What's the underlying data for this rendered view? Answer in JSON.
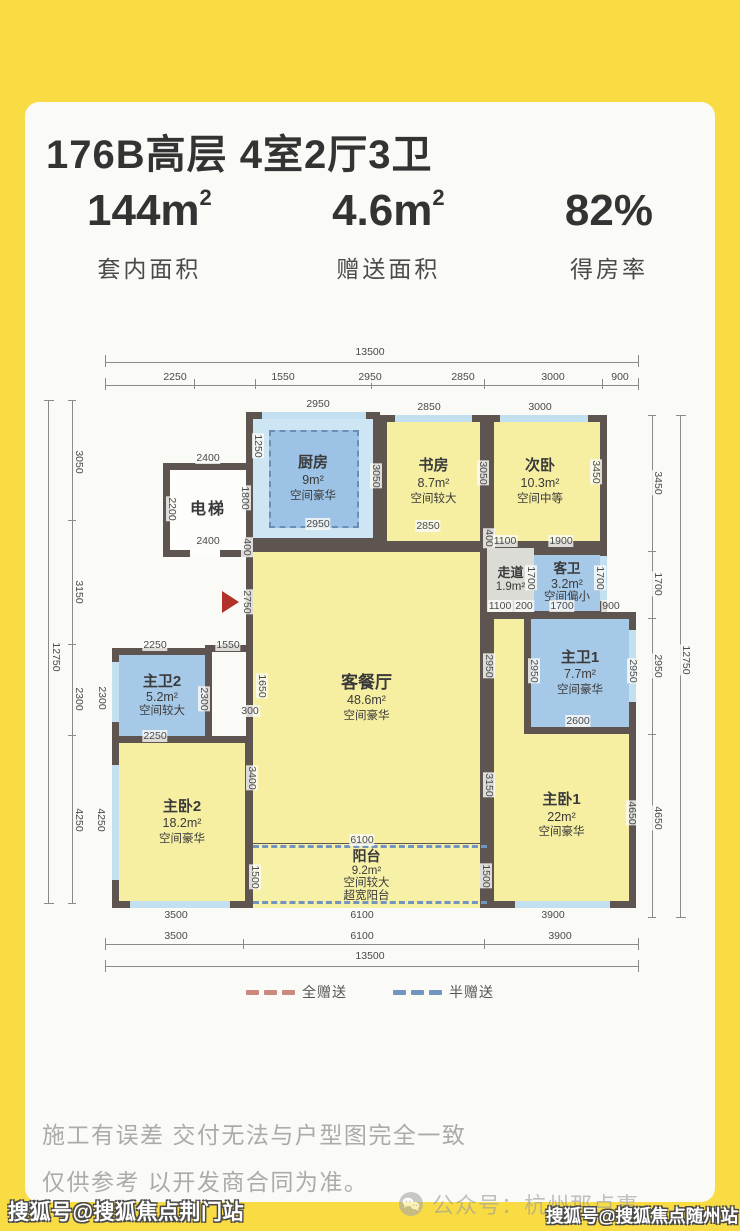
{
  "page": {
    "bg": "#F9DC43",
    "card_bg": "#FAFAF6"
  },
  "header": {
    "title": "176B高层 4室2厅3卫"
  },
  "stats": [
    {
      "value": "144",
      "unit": "m",
      "unit_sup": "2",
      "label": "套内面积"
    },
    {
      "value": "4.6",
      "unit": "m",
      "unit_sup": "2",
      "label": "赠送面积"
    },
    {
      "value": "82%",
      "unit": "",
      "unit_sup": "",
      "label": "得房率"
    }
  ],
  "floorplan": {
    "wall_color": "#5E5551",
    "entry_arrow_color": "#B23128",
    "rooms": [
      {
        "id": "living",
        "name": "客餐厅",
        "area": "48.6m²",
        "grade": "空间豪华"
      },
      {
        "id": "master-bed-1",
        "name": "主卧1",
        "area": "22m²",
        "grade": "空间豪华"
      },
      {
        "id": "master-bath-1",
        "name": "主卫1",
        "area": "7.7m²",
        "grade": "空间豪华"
      },
      {
        "id": "bedroom-2",
        "name": "次卧",
        "area": "10.3m²",
        "grade": "空间中等"
      },
      {
        "id": "guest-bath",
        "name": "客卫",
        "area": "3.2m²",
        "grade": "空间偏小"
      },
      {
        "id": "corridor",
        "name": "走道",
        "area": "1.9m²",
        "grade": ""
      },
      {
        "id": "kitchen",
        "name": "厨房",
        "area": "9m²",
        "grade": "空间豪华"
      },
      {
        "id": "elevator",
        "name": "电梯",
        "area": "",
        "grade": ""
      },
      {
        "id": "study",
        "name": "书房",
        "area": "8.7m²",
        "grade": "空间较大"
      },
      {
        "id": "master-bath-2",
        "name": "主卫2",
        "area": "5.2m²",
        "grade": "空间较大"
      },
      {
        "id": "master-bed-2",
        "name": "主卧2",
        "area": "18.2m²",
        "grade": "空间豪华"
      },
      {
        "id": "balcony",
        "name": "阳台",
        "area": "9.2m²",
        "grade": "空间较大",
        "extra": "超宽阳台"
      }
    ],
    "dims": [
      {
        "t": "13500",
        "x": 370,
        "y": 352
      },
      {
        "t": "2250",
        "x": 175,
        "y": 377
      },
      {
        "t": "1550",
        "x": 283,
        "y": 377
      },
      {
        "t": "2950",
        "x": 370,
        "y": 377
      },
      {
        "t": "2850",
        "x": 463,
        "y": 377
      },
      {
        "t": "3000",
        "x": 553,
        "y": 377
      },
      {
        "t": "900",
        "x": 620,
        "y": 377
      },
      {
        "t": "2950",
        "x": 318,
        "y": 404
      },
      {
        "t": "2850",
        "x": 429,
        "y": 407
      },
      {
        "t": "3000",
        "x": 540,
        "y": 407
      },
      {
        "t": "2400",
        "x": 208,
        "y": 458
      },
      {
        "t": "1250",
        "x": 258,
        "y": 446,
        "v": 1
      },
      {
        "t": "2200",
        "x": 172,
        "y": 509,
        "v": 1
      },
      {
        "t": "1800",
        "x": 245,
        "y": 498,
        "v": 1
      },
      {
        "t": "2400",
        "x": 208,
        "y": 541
      },
      {
        "t": "400",
        "x": 247,
        "y": 547,
        "v": 1
      },
      {
        "t": "2950",
        "x": 318,
        "y": 524
      },
      {
        "t": "3050",
        "x": 376,
        "y": 476,
        "v": 1
      },
      {
        "t": "2850",
        "x": 428,
        "y": 526
      },
      {
        "t": "3050",
        "x": 483,
        "y": 473,
        "v": 1
      },
      {
        "t": "3450",
        "x": 596,
        "y": 472,
        "v": 1
      },
      {
        "t": "400",
        "x": 489,
        "y": 538,
        "v": 1
      },
      {
        "t": "1100",
        "x": 505,
        "y": 541
      },
      {
        "t": "1900",
        "x": 561,
        "y": 541
      },
      {
        "t": "1700",
        "x": 531,
        "y": 578,
        "v": 1
      },
      {
        "t": "1700",
        "x": 600,
        "y": 578,
        "v": 1
      },
      {
        "t": "1100",
        "x": 500,
        "y": 606
      },
      {
        "t": "200",
        "x": 524,
        "y": 606
      },
      {
        "t": "1700",
        "x": 562,
        "y": 606
      },
      {
        "t": "900",
        "x": 611,
        "y": 606
      },
      {
        "t": "2750",
        "x": 247,
        "y": 602,
        "v": 1
      },
      {
        "t": "2250",
        "x": 155,
        "y": 645
      },
      {
        "t": "1550",
        "x": 228,
        "y": 645
      },
      {
        "t": "2300",
        "x": 102,
        "y": 698,
        "v": 1
      },
      {
        "t": "2300",
        "x": 204,
        "y": 699,
        "v": 1
      },
      {
        "t": "2250",
        "x": 155,
        "y": 736
      },
      {
        "t": "1650",
        "x": 262,
        "y": 686,
        "v": 1
      },
      {
        "t": "300",
        "x": 250,
        "y": 711
      },
      {
        "t": "3400",
        "x": 252,
        "y": 778,
        "v": 1
      },
      {
        "t": "2950",
        "x": 489,
        "y": 666,
        "v": 1
      },
      {
        "t": "3150",
        "x": 489,
        "y": 785,
        "v": 1
      },
      {
        "t": "2950",
        "x": 534,
        "y": 671,
        "v": 1
      },
      {
        "t": "2950",
        "x": 633,
        "y": 671,
        "v": 1
      },
      {
        "t": "2600",
        "x": 578,
        "y": 721
      },
      {
        "t": "4650",
        "x": 632,
        "y": 813,
        "v": 1
      },
      {
        "t": "6100",
        "x": 362,
        "y": 840
      },
      {
        "t": "1500",
        "x": 255,
        "y": 877,
        "v": 1
      },
      {
        "t": "1500",
        "x": 486,
        "y": 876,
        "v": 1
      },
      {
        "t": "3500",
        "x": 176,
        "y": 915
      },
      {
        "t": "6100",
        "x": 362,
        "y": 915
      },
      {
        "t": "3900",
        "x": 553,
        "y": 915
      },
      {
        "t": "3050",
        "x": 79,
        "y": 462,
        "v": 1
      },
      {
        "t": "3150",
        "x": 79,
        "y": 592,
        "v": 1
      },
      {
        "t": "2300",
        "x": 79,
        "y": 699,
        "v": 1
      },
      {
        "t": "4250",
        "x": 79,
        "y": 820,
        "v": 1
      },
      {
        "t": "4250",
        "x": 101,
        "y": 820,
        "v": 1
      },
      {
        "t": "12750",
        "x": 56,
        "y": 657,
        "v": 1
      },
      {
        "t": "3450",
        "x": 658,
        "y": 483,
        "v": 1
      },
      {
        "t": "1700",
        "x": 658,
        "y": 584,
        "v": 1
      },
      {
        "t": "2950",
        "x": 658,
        "y": 666,
        "v": 1
      },
      {
        "t": "4650",
        "x": 658,
        "y": 818,
        "v": 1
      },
      {
        "t": "12750",
        "x": 686,
        "y": 660,
        "v": 1
      },
      {
        "t": "3500",
        "x": 176,
        "y": 936
      },
      {
        "t": "6100",
        "x": 362,
        "y": 936
      },
      {
        "t": "3900",
        "x": 560,
        "y": 936
      },
      {
        "t": "13500",
        "x": 370,
        "y": 956
      }
    ]
  },
  "legend": {
    "items": [
      {
        "label": "全赠送",
        "color": "#C9897C"
      },
      {
        "label": "半赠送",
        "color": "#7295BF"
      }
    ]
  },
  "disclaimer": {
    "line1": "施工有误差 交付无法与户型图完全一致",
    "line2": "仅供参考 以开发商合同为准。"
  },
  "footer": {
    "wechat_label": "公众号：杭州那点事"
  },
  "watermarks": {
    "bottom_left": "搜狐号@搜狐焦点荆门站",
    "bottom_right": "搜狐号@搜狐焦点随州站"
  }
}
